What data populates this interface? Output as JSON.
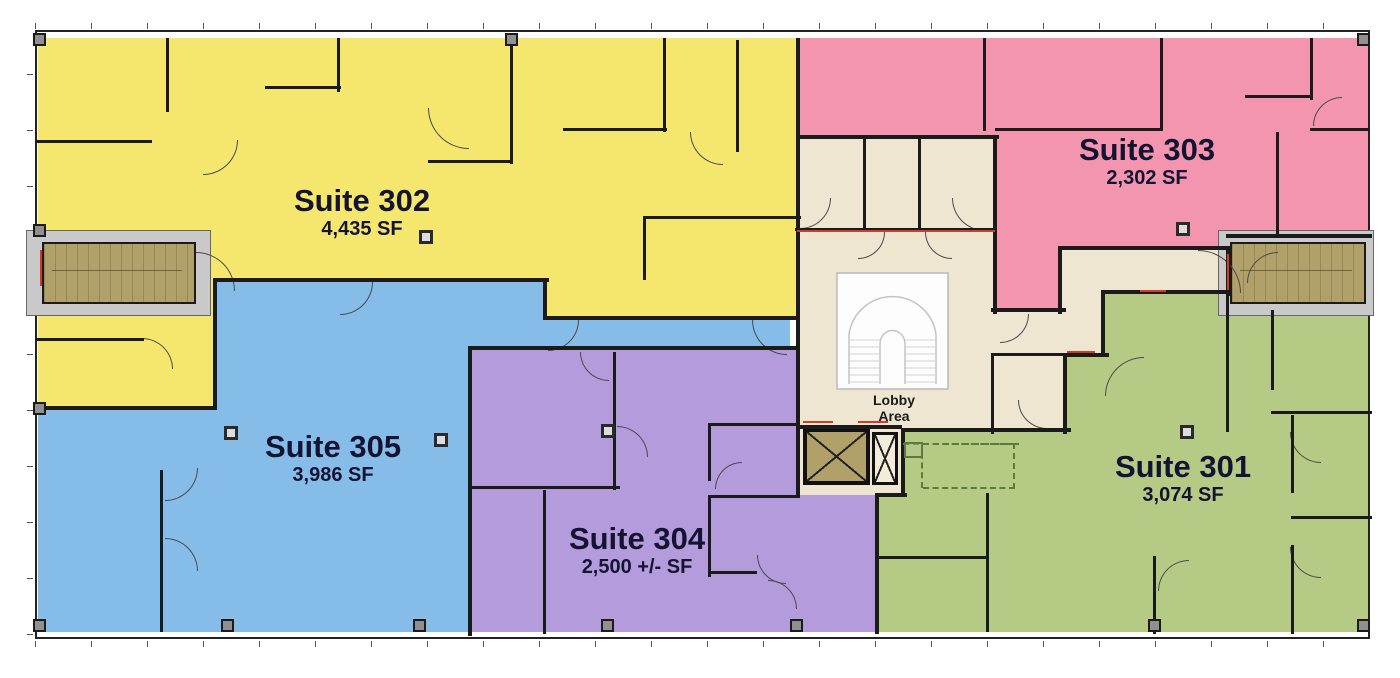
{
  "plan": {
    "suites": [
      {
        "name": "Suite 301",
        "area_label": "3,074 SF",
        "color": "#b5ca84"
      },
      {
        "name": "Suite 302",
        "area_label": "4,435 SF",
        "color": "#f5e76e"
      },
      {
        "name": "Suite 303",
        "area_label": "2,302 SF",
        "color": "#f495af"
      },
      {
        "name": "Suite 304",
        "area_label": "2,500 +/- SF",
        "color": "#b49bdb"
      },
      {
        "name": "Suite 305",
        "area_label": "3,986 SF",
        "color": "#85bce8"
      }
    ],
    "lobby": {
      "line1": "Lobby",
      "line2": "Area",
      "color": "#efe6d1"
    },
    "colors": {
      "background": "#ffffff",
      "wall": "#1b1b1b",
      "stairwell": "#b2a06a",
      "wall_surround": "#c9c9c9",
      "accent_red": "#d23b2a",
      "label_text": "#141432"
    }
  }
}
